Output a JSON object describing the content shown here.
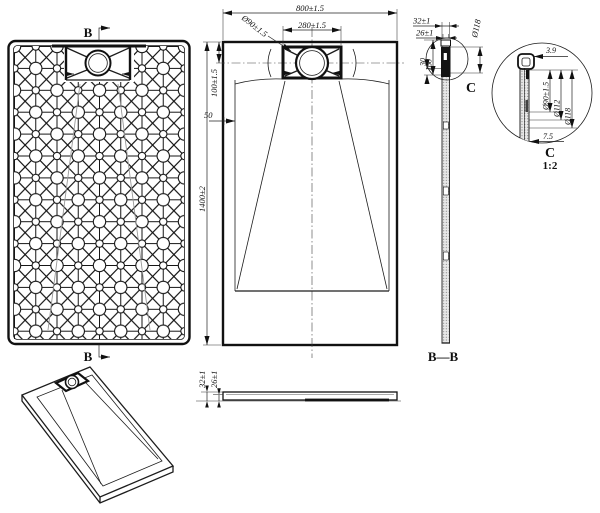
{
  "drawing": {
    "bottom_view": {
      "section_marker_top": "B",
      "section_marker_bottom": "B"
    },
    "plan_view": {
      "overall_width": "800±1.5",
      "drain_box_width": "280±1.5",
      "drain_diameter": "Ø90±1.5",
      "drain_offset_top": "100±1.5",
      "edge_offset": "50",
      "overall_length": "1400±2"
    },
    "section_bb": {
      "label": "B—B",
      "thickness_total": "32±1",
      "thickness_inner": "26±1",
      "flange_diameter": "Ø118",
      "boss_height": "30",
      "boss_depth": "160",
      "detail_marker": "C"
    },
    "detail_c": {
      "label": "C",
      "scale": "1:2",
      "lip_thickness": "3.9",
      "hole_diameter": "Ø90±1.5",
      "recess_diameter": "Ø112",
      "outer_diameter": "Ø118",
      "edge_height": "7.5"
    },
    "side_view": {
      "thickness_total": "32±1",
      "thickness_inner": "26±1"
    }
  }
}
